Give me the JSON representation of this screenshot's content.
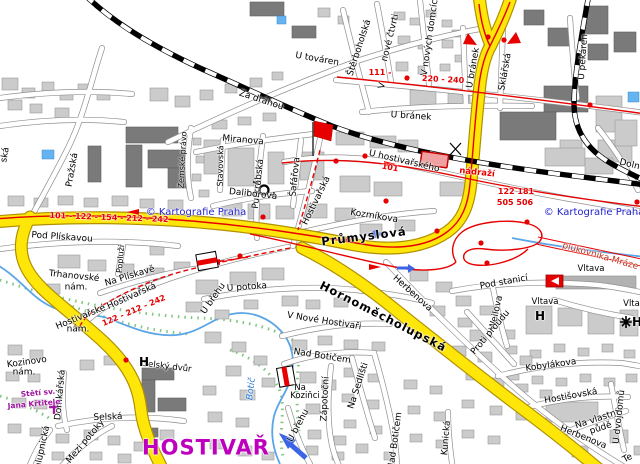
{
  "map": {
    "publisher": "© Kartografie Praha",
    "district": "HOSTIVAŘ",
    "description": "City street map of Hostivař district, Prague, with railway, bus routes and Botič stream"
  },
  "colors": {
    "road_major": "#FFE609",
    "route_red": "#E60000",
    "rail": "#000000",
    "water": "#5AA5E6",
    "building": "#CBCBCB",
    "building_dark": "#7A7A7A",
    "copyright_blue": "#2323CD",
    "district_purple": "#BE00BE",
    "church_purple": "#A014A0",
    "vegetation": "#50B450"
  },
  "icons": [
    {
      "name": "red-flag",
      "x": 322,
      "y": 131
    },
    {
      "name": "postal-horn-icon",
      "x": 264,
      "y": 190
    },
    {
      "name": "railway-station-building",
      "x": 434,
      "y": 159
    },
    {
      "name": "landmark-sign-horizontal-stripe",
      "x": 207,
      "y": 261
    },
    {
      "name": "landmark-sign-vertical-stripe",
      "x": 286,
      "y": 376
    },
    {
      "name": "landmark-logo-triangle",
      "x": 554,
      "y": 281
    },
    {
      "name": "church-cross-icon",
      "x": 54,
      "y": 408
    },
    {
      "name": "star-icon",
      "x": 626,
      "y": 322
    },
    {
      "name": "one-way-arrow-west",
      "x": 381,
      "y": 234
    },
    {
      "name": "one-way-arrow-east",
      "x": 404,
      "y": 268
    },
    {
      "name": "stream-flow-arrow",
      "x": 293,
      "y": 446
    },
    {
      "name": "level-crossing-mark",
      "x": 455,
      "y": 149
    }
  ],
  "labels": [
    {
      "text": "Za dráhou",
      "kind": "street",
      "x": 261,
      "y": 101,
      "rot": 18
    },
    {
      "text": "U továren",
      "kind": "street",
      "x": 317,
      "y": 60,
      "rot": 10
    },
    {
      "text": "Miranova",
      "kind": "street",
      "x": 243,
      "y": 141,
      "rot": 5
    },
    {
      "text": "Zemské právo",
      "kind": "street",
      "x": 183,
      "y": 160,
      "rot": -87,
      "size": 8
    },
    {
      "text": "Stavovská",
      "kind": "street",
      "x": 221,
      "y": 166,
      "rot": -89,
      "size": 8
    },
    {
      "text": "Purkrabská",
      "kind": "street",
      "x": 259,
      "y": 184,
      "rot": -84
    },
    {
      "text": "Šafářova",
      "kind": "street",
      "x": 296,
      "y": 177,
      "rot": -84
    },
    {
      "text": "Daliborova",
      "kind": "street",
      "x": 253,
      "y": 195,
      "rot": 6
    },
    {
      "text": "Hostivařská",
      "kind": "street",
      "x": 317,
      "y": 201,
      "rot": -64
    },
    {
      "text": "Kozmíkova",
      "kind": "street",
      "x": 374,
      "y": 217,
      "rot": 9
    },
    {
      "text": "Štěrboholská",
      "kind": "street",
      "x": 360,
      "y": 48,
      "rot": -72
    },
    {
      "text": "nové čtvrti",
      "kind": "street",
      "x": 391,
      "y": 38,
      "rot": -76
    },
    {
      "text": "V",
      "kind": "street",
      "x": 383,
      "y": 86,
      "rot": -76
    },
    {
      "text": "V nových domcích",
      "kind": "street",
      "x": 431,
      "y": 35,
      "rot": -82
    },
    {
      "text": "U bránek",
      "kind": "street",
      "x": 474,
      "y": 68,
      "rot": -80
    },
    {
      "text": "Sklářská",
      "kind": "street",
      "x": 506,
      "y": 72,
      "rot": -80
    },
    {
      "text": "U bránek",
      "kind": "street",
      "x": 411,
      "y": 117,
      "rot": 4
    },
    {
      "text": "U pekáren",
      "kind": "street",
      "x": 584,
      "y": 57,
      "rot": -86
    },
    {
      "text": "U hostivařského",
      "kind": "street",
      "x": 404,
      "y": 162,
      "rot": 13
    },
    {
      "text": "nádraží",
      "kind": "route",
      "x": 477,
      "y": 173,
      "rot": 6,
      "size": 8.5
    },
    {
      "text": "Dolno",
      "kind": "street",
      "x": 632,
      "y": 166,
      "rot": 14
    },
    {
      "text": "Pražská",
      "kind": "street",
      "x": 73,
      "y": 170,
      "rot": -80
    },
    {
      "text": "Pod Plískavou",
      "kind": "street",
      "x": 62,
      "y": 238,
      "rot": 4
    },
    {
      "text": "Trhanovské",
      "kind": "street",
      "x": 74,
      "y": 277,
      "rot": 6
    },
    {
      "text": "nám.",
      "kind": "street",
      "x": 76,
      "y": 288,
      "rot": 0
    },
    {
      "text": "Na Plískavě",
      "kind": "street",
      "x": 130,
      "y": 277,
      "rot": -17
    },
    {
      "text": "Popluží",
      "kind": "street",
      "x": 121,
      "y": 259,
      "rot": -85,
      "size": 8
    },
    {
      "text": "Hostivařská",
      "kind": "street",
      "x": 132,
      "y": 297,
      "rot": -24
    },
    {
      "text": "Hostivařské",
      "kind": "street",
      "x": 81,
      "y": 318,
      "rot": -22
    },
    {
      "text": "nám.",
      "kind": "street",
      "x": 78,
      "y": 330,
      "rot": 0
    },
    {
      "text": "Kozinovo",
      "kind": "street",
      "x": 27,
      "y": 363,
      "rot": -8
    },
    {
      "text": "nám.",
      "kind": "street",
      "x": 24,
      "y": 373,
      "rot": 0
    },
    {
      "text": "Domkářská",
      "kind": "street",
      "x": 61,
      "y": 395,
      "rot": -85
    },
    {
      "text": "Selská",
      "kind": "street",
      "x": 108,
      "y": 418,
      "rot": -2
    },
    {
      "text": "Mezi potoky",
      "kind": "street",
      "x": 86,
      "y": 442,
      "rot": -50
    },
    {
      "text": "Chalupnická",
      "kind": "street",
      "x": 42,
      "y": 453,
      "rot": -78
    },
    {
      "text": "U potoka",
      "kind": "street",
      "x": 247,
      "y": 288,
      "rot": -4
    },
    {
      "text": "U břehu",
      "kind": "street",
      "x": 214,
      "y": 299,
      "rot": -55
    },
    {
      "text": "V Nové Hostivaři",
      "kind": "street",
      "x": 324,
      "y": 322,
      "rot": 9
    },
    {
      "text": "Nad Botičem",
      "kind": "street",
      "x": 322,
      "y": 357,
      "rot": 9
    },
    {
      "text": "Zápotoční",
      "kind": "street",
      "x": 326,
      "y": 399,
      "rot": -87
    },
    {
      "text": "Na Sedlišti",
      "kind": "street",
      "x": 359,
      "y": 386,
      "rot": -72
    },
    {
      "text": "Nad Botičem",
      "kind": "street",
      "x": 396,
      "y": 441,
      "rot": -82
    },
    {
      "text": "Kunická",
      "kind": "street",
      "x": 447,
      "y": 438,
      "rot": -85
    },
    {
      "text": "Herbenova",
      "kind": "street",
      "x": 412,
      "y": 294,
      "rot": 42
    },
    {
      "text": "Pod stanicí",
      "kind": "street",
      "x": 504,
      "y": 283,
      "rot": -10
    },
    {
      "text": "Weilova",
      "kind": "street",
      "x": 497,
      "y": 313,
      "rot": -78
    },
    {
      "text": "Proti proudu",
      "kind": "street",
      "x": 491,
      "y": 333,
      "rot": -50
    },
    {
      "text": "Kobylákova",
      "kind": "street",
      "x": 551,
      "y": 366,
      "rot": -8
    },
    {
      "text": "Hostišovská",
      "kind": "street",
      "x": 571,
      "y": 397,
      "rot": -10
    },
    {
      "text": "Na vlastní",
      "kind": "street",
      "x": 597,
      "y": 420,
      "rot": -18
    },
    {
      "text": "půdě",
      "kind": "street",
      "x": 601,
      "y": 429,
      "rot": -18
    },
    {
      "text": "U dvojdomů",
      "kind": "street",
      "x": 620,
      "y": 417,
      "rot": -84
    },
    {
      "text": "Herbenova",
      "kind": "street",
      "x": 583,
      "y": 438,
      "rot": 22
    },
    {
      "text": "U břehu",
      "kind": "street",
      "x": 299,
      "y": 426,
      "rot": -62
    },
    {
      "text": "ská",
      "kind": "street",
      "x": 6,
      "y": 155,
      "rot": -80
    },
    {
      "text": "Te",
      "kind": "street",
      "x": 628,
      "y": 459,
      "rot": -30
    },
    {
      "text": "Průmyslová",
      "kind": "major",
      "x": 364,
      "y": 237,
      "rot": -7
    },
    {
      "text": "Hornoměcholupská",
      "kind": "major",
      "x": 383,
      "y": 317,
      "rot": 27
    },
    {
      "text": "101 - 122 - 154 - 212 - 242",
      "kind": "route",
      "x": 109,
      "y": 218,
      "rot": 2
    },
    {
      "text": "111 -",
      "kind": "route",
      "x": 380,
      "y": 73,
      "rot": 0
    },
    {
      "text": "220 - 240",
      "kind": "route",
      "x": 443,
      "y": 80,
      "rot": 3
    },
    {
      "text": "101",
      "kind": "route",
      "x": 390,
      "y": 168,
      "rot": 10
    },
    {
      "text": "122  181",
      "kind": "route",
      "x": 516,
      "y": 192,
      "rot": 0
    },
    {
      "text": "505 506",
      "kind": "route",
      "x": 515,
      "y": 203,
      "rot": 0
    },
    {
      "text": "122 - 212 - 242",
      "kind": "route",
      "x": 134,
      "y": 311,
      "rot": -23
    },
    {
      "text": "plukovníka Mráze",
      "kind": "redstreet",
      "x": 600,
      "y": 257,
      "rot": 16
    },
    {
      "text": "Botič",
      "kind": "water",
      "x": 252,
      "y": 389,
      "rot": -83
    },
    {
      "text": "Selský dvůr",
      "kind": "land",
      "x": 167,
      "y": 367,
      "rot": 7
    },
    {
      "text": "Vltava",
      "kind": "land",
      "x": 591,
      "y": 269,
      "rot": 0
    },
    {
      "text": "Vltava",
      "kind": "land",
      "x": 545,
      "y": 302,
      "rot": 0
    },
    {
      "text": "Vltav",
      "kind": "land",
      "x": 634,
      "y": 304,
      "rot": 0
    },
    {
      "text": "Na",
      "kind": "land",
      "x": 300,
      "y": 388,
      "rot": 0
    },
    {
      "text": "Koziňci",
      "kind": "land",
      "x": 305,
      "y": 396,
      "rot": 0
    },
    {
      "text": "H",
      "kind": "hotel",
      "x": 144,
      "y": 362,
      "rot": 0
    },
    {
      "text": "H",
      "kind": "hotel",
      "x": 540,
      "y": 316,
      "rot": 0
    },
    {
      "text": "H",
      "kind": "hotel",
      "x": 637,
      "y": 322,
      "rot": 0
    },
    {
      "text": "Stětí sv.",
      "kind": "church",
      "x": 38,
      "y": 393,
      "rot": -5
    },
    {
      "text": "Jana Křtitele",
      "kind": "church",
      "x": 34,
      "y": 404,
      "rot": -5
    },
    {
      "text": "HOSTIVAŘ",
      "kind": "district",
      "x": 206,
      "y": 448,
      "rot": 0
    },
    {
      "text": "© Kartografie Praha",
      "kind": "copy",
      "x": 196,
      "y": 213,
      "rot": 0
    },
    {
      "text": "© Kartografie Praha",
      "kind": "copy",
      "x": 594,
      "y": 213,
      "rot": 0
    }
  ]
}
